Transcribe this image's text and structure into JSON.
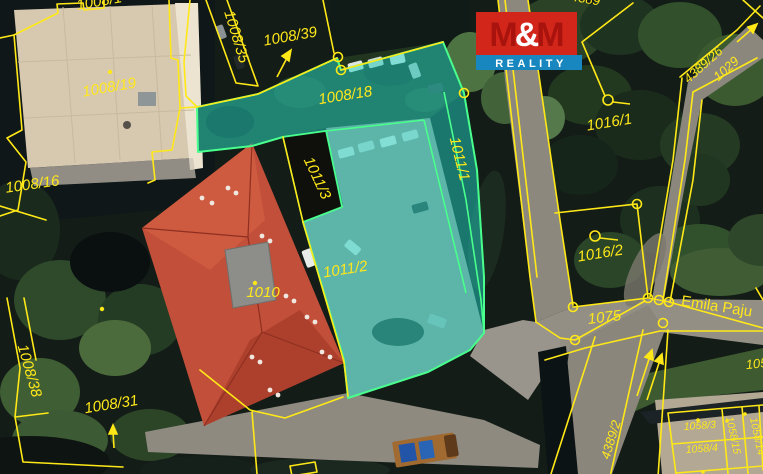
{
  "logo": {
    "m1": "M",
    "amp": "&",
    "m2": "M",
    "reality": "REALITY",
    "red": "#d2261b",
    "blue": "#1887bf"
  },
  "colors": {
    "boundary_yellow": "#ffe817",
    "highlight_fill": "#20d2be",
    "highlight_stroke": "#49ff8d",
    "label_yellow": "#ffe81a"
  },
  "labels": {
    "p1008_1": "1008/1",
    "p1008_19": "1008/19",
    "p1008_35": "1008/35",
    "p1008_39": "1008/39",
    "p1008_16": "1008/16",
    "p1008_18": "1008/18",
    "p1008_31": "1008/31",
    "p1008_38": "1008/38",
    "p1010": "1010",
    "p1011_1": "1011/1",
    "p1011_2": "1011/2",
    "p1011_3": "1011/3",
    "p1016_1": "1016/1",
    "p1016_2": "1016/2",
    "p1075": "1075",
    "p1029": "1029",
    "p4389_26": "4389/26",
    "p4389_2": "4389/2",
    "p4389_top": "4389",
    "p1058_3": "1058/3",
    "p1058_4": "1058/4",
    "p1058_15": "1058/15",
    "p1058_14": "1058/14",
    "p105_part": "105",
    "street_emila": "Emila Paju"
  }
}
